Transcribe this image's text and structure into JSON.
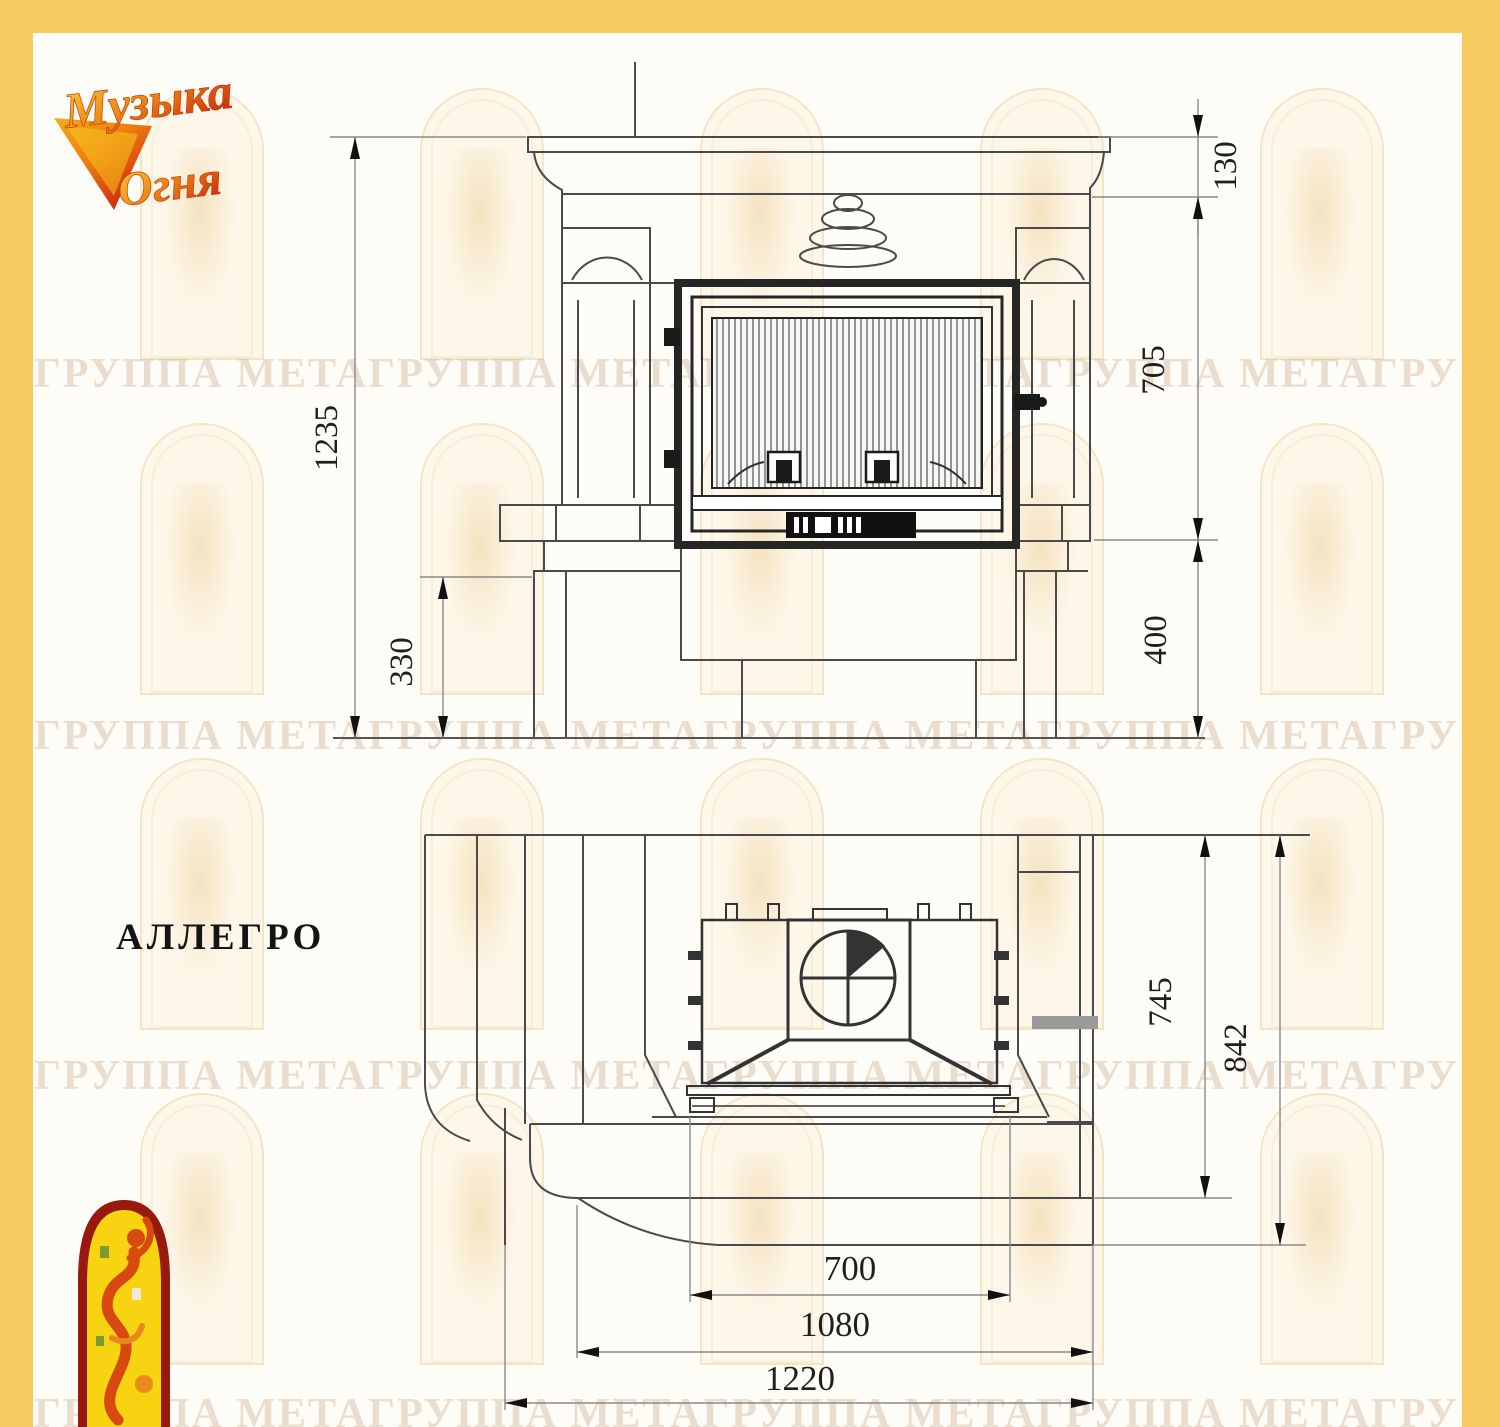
{
  "brand": {
    "line1": "Музыка",
    "line2": "Огня"
  },
  "product_name": "АЛЛЕГРО",
  "watermark_text": "ГРУППА МЕТА",
  "front_view": {
    "total_height": "1235",
    "shelf_band_height": "130",
    "opening_height": "705",
    "base_height": "400",
    "side_step_height": "330"
  },
  "plan_view": {
    "depth_to_bench_front": "745",
    "total_depth": "842",
    "opening_width": "700",
    "inner_width": "1080",
    "total_width": "1220"
  },
  "colors": {
    "frame_yellow": "#f6ca60",
    "logo_fire_yellow": "#f2ae14",
    "logo_fire_orange": "#ee7d10",
    "logo_fire_red": "#d1310f",
    "emblem_border": "#98190d",
    "emblem_fill": "#f7d312"
  }
}
